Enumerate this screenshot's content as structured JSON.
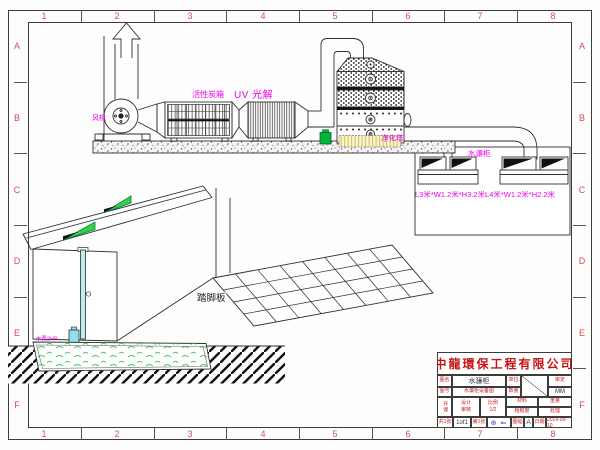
{
  "frame": {
    "cols": [
      "1",
      "2",
      "3",
      "4",
      "5",
      "6",
      "7",
      "8"
    ],
    "rows": [
      "A",
      "B",
      "C",
      "D",
      "E",
      "F"
    ]
  },
  "labels": {
    "fan": "风机",
    "carbon_box": "活性炭箱",
    "uv": "UV 光解",
    "tower": "净化塔",
    "water_curtain": "水濂柜",
    "dimensions": "L3米*W1.2米*H3.2米L4米*W1.2米*H2.2米",
    "pump": "水泵2HP",
    "tread_plate": "踏脚板"
  },
  "title_block": {
    "company": "中龍環保工程有限公司",
    "name_label": "图名",
    "name": "水濂柜",
    "unit_label": "单位",
    "rev_label": "审定",
    "no_label": "图号",
    "drawing_no": "水濂柜设备图",
    "qty_label": "数量",
    "units": "MM",
    "dept": "环保",
    "design_label": "设计",
    "check_label": "审核",
    "scale_label": "比例",
    "scale": "1/2",
    "material_label": "材料",
    "weight_label": "重量",
    "roughness_label": "粗糙度",
    "finish_label": "处理",
    "sheets_label": "共1张",
    "sheet": "1of1",
    "sheet2_label": "第1张",
    "projection": "⊕ ⇐",
    "size_label": "图幅",
    "size": "A",
    "date_label": "日期",
    "date": "2019-06-10"
  },
  "colors": {
    "line": "#2f2f2f",
    "ruler_red": "#d05050",
    "label_magenta": "#ee00ee",
    "title_red": "#c41414",
    "vent_green": "#2fd14f",
    "pump_green": "#00b43c",
    "pipe_cyan": "#c2ecf2",
    "tank_yellow": "#f8f4cd",
    "projection_blue": "#4a3bd0"
  }
}
